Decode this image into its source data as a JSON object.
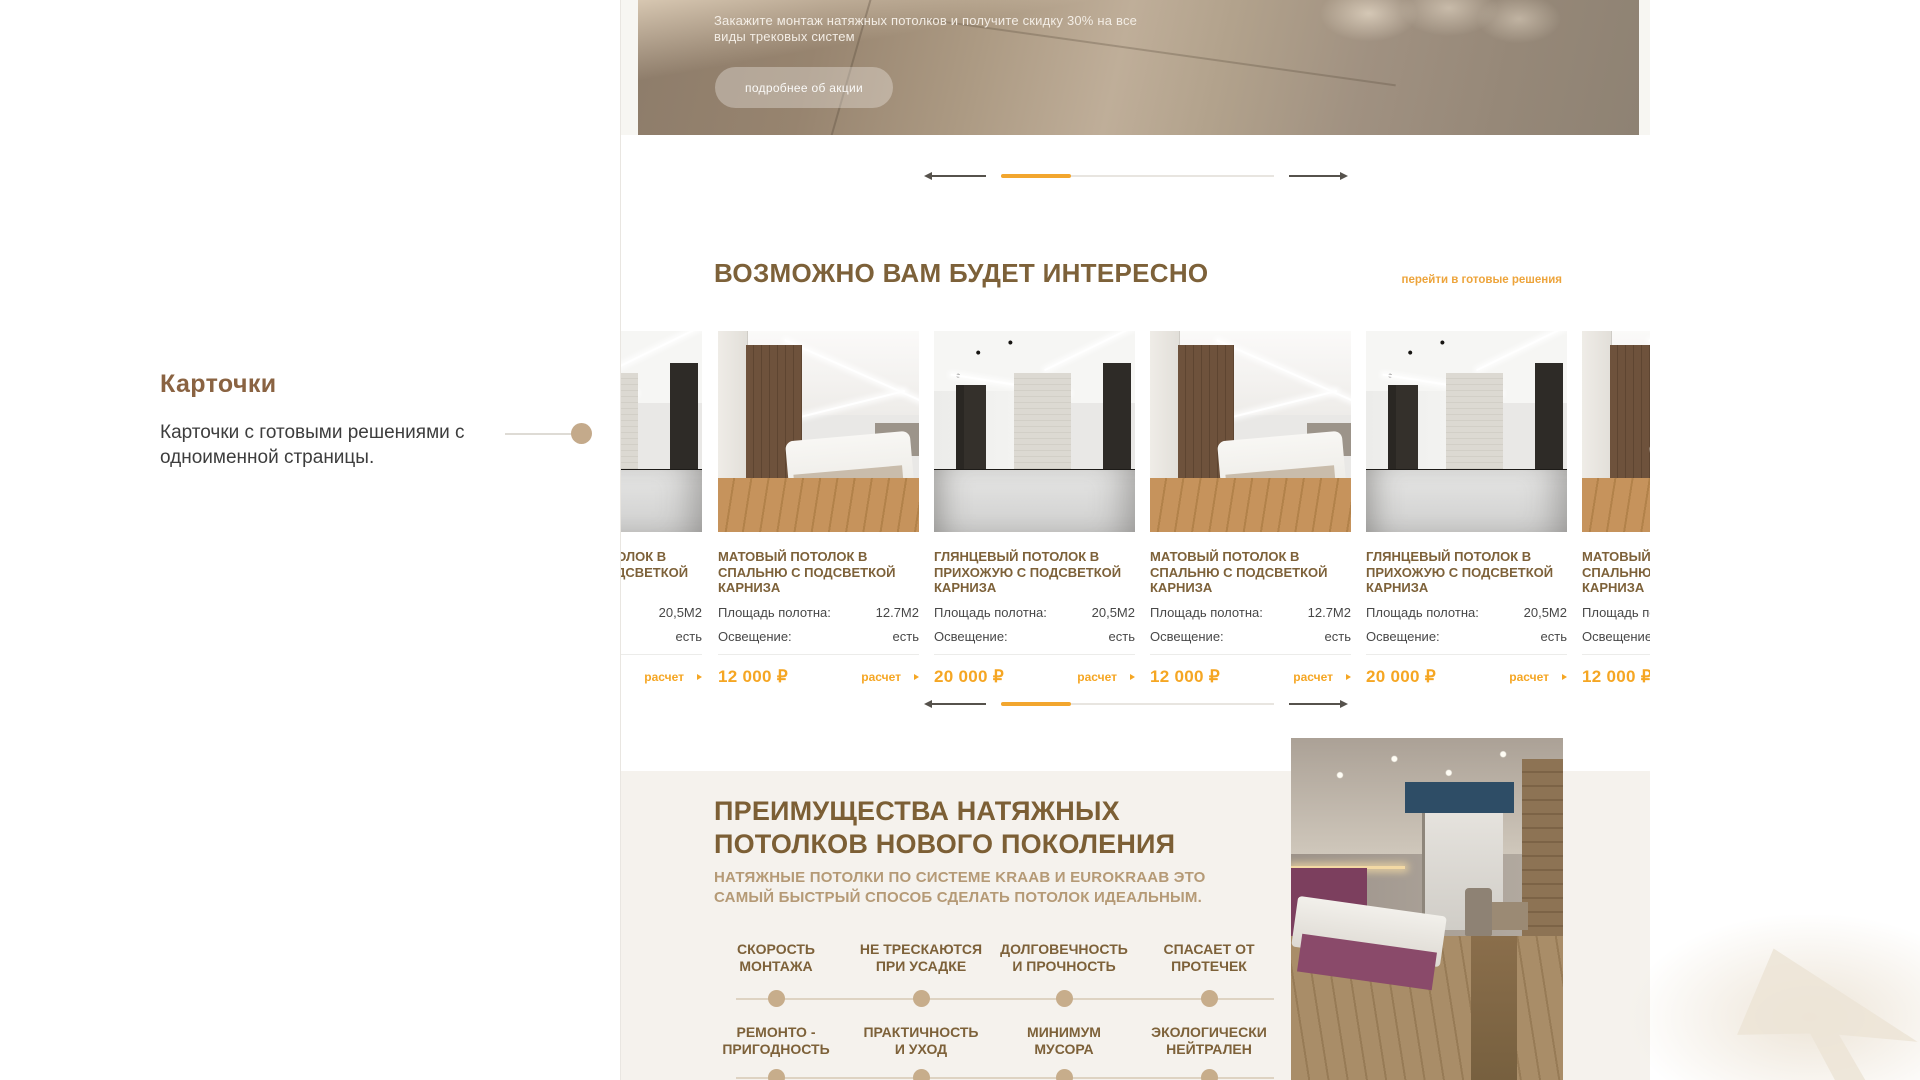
{
  "annotation": {
    "title": "Карточки",
    "description": "Карточки с готовыми решениями с одноименной страницы."
  },
  "banner": {
    "line1": "Закажите монтаж натяжных потолков и получите скидку 30% на все",
    "line2": "виды трековых систем",
    "button": "подробнее об акции"
  },
  "interesting": {
    "title": "ВОЗМОЖНО ВАМ БУДЕТ ИНТЕРЕСНО",
    "link": "перейти в готовые решения",
    "spec_area_label": "Площадь полотна:",
    "spec_light_label": "Освещение:",
    "calc_label": "расчет",
    "cards": [
      {
        "title": "ГЛЯНЦЕВЫЙ ПОТОЛОК В ПРИХОЖУЮ С ПОДСВЕТКОЙ КАРНИЗА",
        "area": "20,5М2",
        "light": "есть",
        "price": "20 000 ₽",
        "type": "hallway"
      },
      {
        "title": "МАТОВЫЙ ПОТОЛОК В СПАЛЬНЮ С ПОДСВЕТКОЙ КАРНИЗА",
        "area": "12.7М2",
        "light": "есть",
        "price": "12 000 ₽",
        "type": "bedroom"
      },
      {
        "title": "ГЛЯНЦЕВЫЙ ПОТОЛОК В ПРИХОЖУЮ С ПОДСВЕТКОЙ КАРНИЗА",
        "area": "20,5М2",
        "light": "есть",
        "price": "20 000 ₽",
        "type": "hallway"
      },
      {
        "title": "МАТОВЫЙ ПОТОЛОК В СПАЛЬНЮ С ПОДСВЕТКОЙ КАРНИЗА",
        "area": "12.7М2",
        "light": "есть",
        "price": "12 000 ₽",
        "type": "bedroom"
      },
      {
        "title": "ГЛЯНЦЕВЫЙ ПОТОЛОК В ПРИХОЖУЮ С ПОДСВЕТКОЙ КАРНИЗА",
        "area": "20,5М2",
        "light": "есть",
        "price": "20 000 ₽",
        "type": "hallway"
      },
      {
        "title": "МАТОВЫЙ ПОТОЛОК В СПАЛЬНЮ С ПОДСВЕТКОЙ КАРНИЗА",
        "area": "12.7М2",
        "light": "есть",
        "price": "12 000 ₽",
        "type": "bedroom"
      }
    ]
  },
  "advantages": {
    "title_line1": "ПРЕИМУЩЕСТВА НАТЯЖНЫХ",
    "title_line2": "ПОТОЛКОВ НОВОГО ПОКОЛЕНИЯ",
    "subtitle_line1": "НАТЯЖНЫЕ ПОТОЛКИ ПО СИСТЕМЕ KRAAB И EUROKRAAB ЭТО",
    "subtitle_line2": "САМЫЙ БЫСТРЫЙ СПОСОБ СДЕЛАТЬ ПОТОЛОК ИДЕАЛЬНЫМ.",
    "features_row1": [
      "СКОРОСТЬ\nМОНТАЖА",
      "НЕ ТРЕСКАЮТСЯ\nПРИ УСАДКЕ",
      "ДОЛГОВЕЧНОСТЬ\nИ ПРОЧНОСТЬ",
      "СПАСАЕТ ОТ\nПРОТЕЧЕК"
    ],
    "features_row2": [
      "РЕМОНТО -\nПРИГОДНОСТЬ",
      "ПРАКТИЧНОСТЬ\nИ УХОД",
      "МИНИМУМ\nМУСОРА",
      "ЭКОЛОГИЧЕСКИ\nНЕЙТРАЛЕН"
    ]
  },
  "icons": {
    "carousel_prev": "arrow-left",
    "carousel_next": "arrow-right",
    "calc_arrow": "triangle-right",
    "annotation_marker": "dot"
  },
  "colors": {
    "accent_orange": "#f2a62e",
    "heading_brown": "#7d6139",
    "annotation_brown": "#8a6342",
    "tan_dot": "#c4aa8b",
    "beige_section_bg": "#f5f2ed",
    "site_frame_bg": "#f7f6f2"
  }
}
